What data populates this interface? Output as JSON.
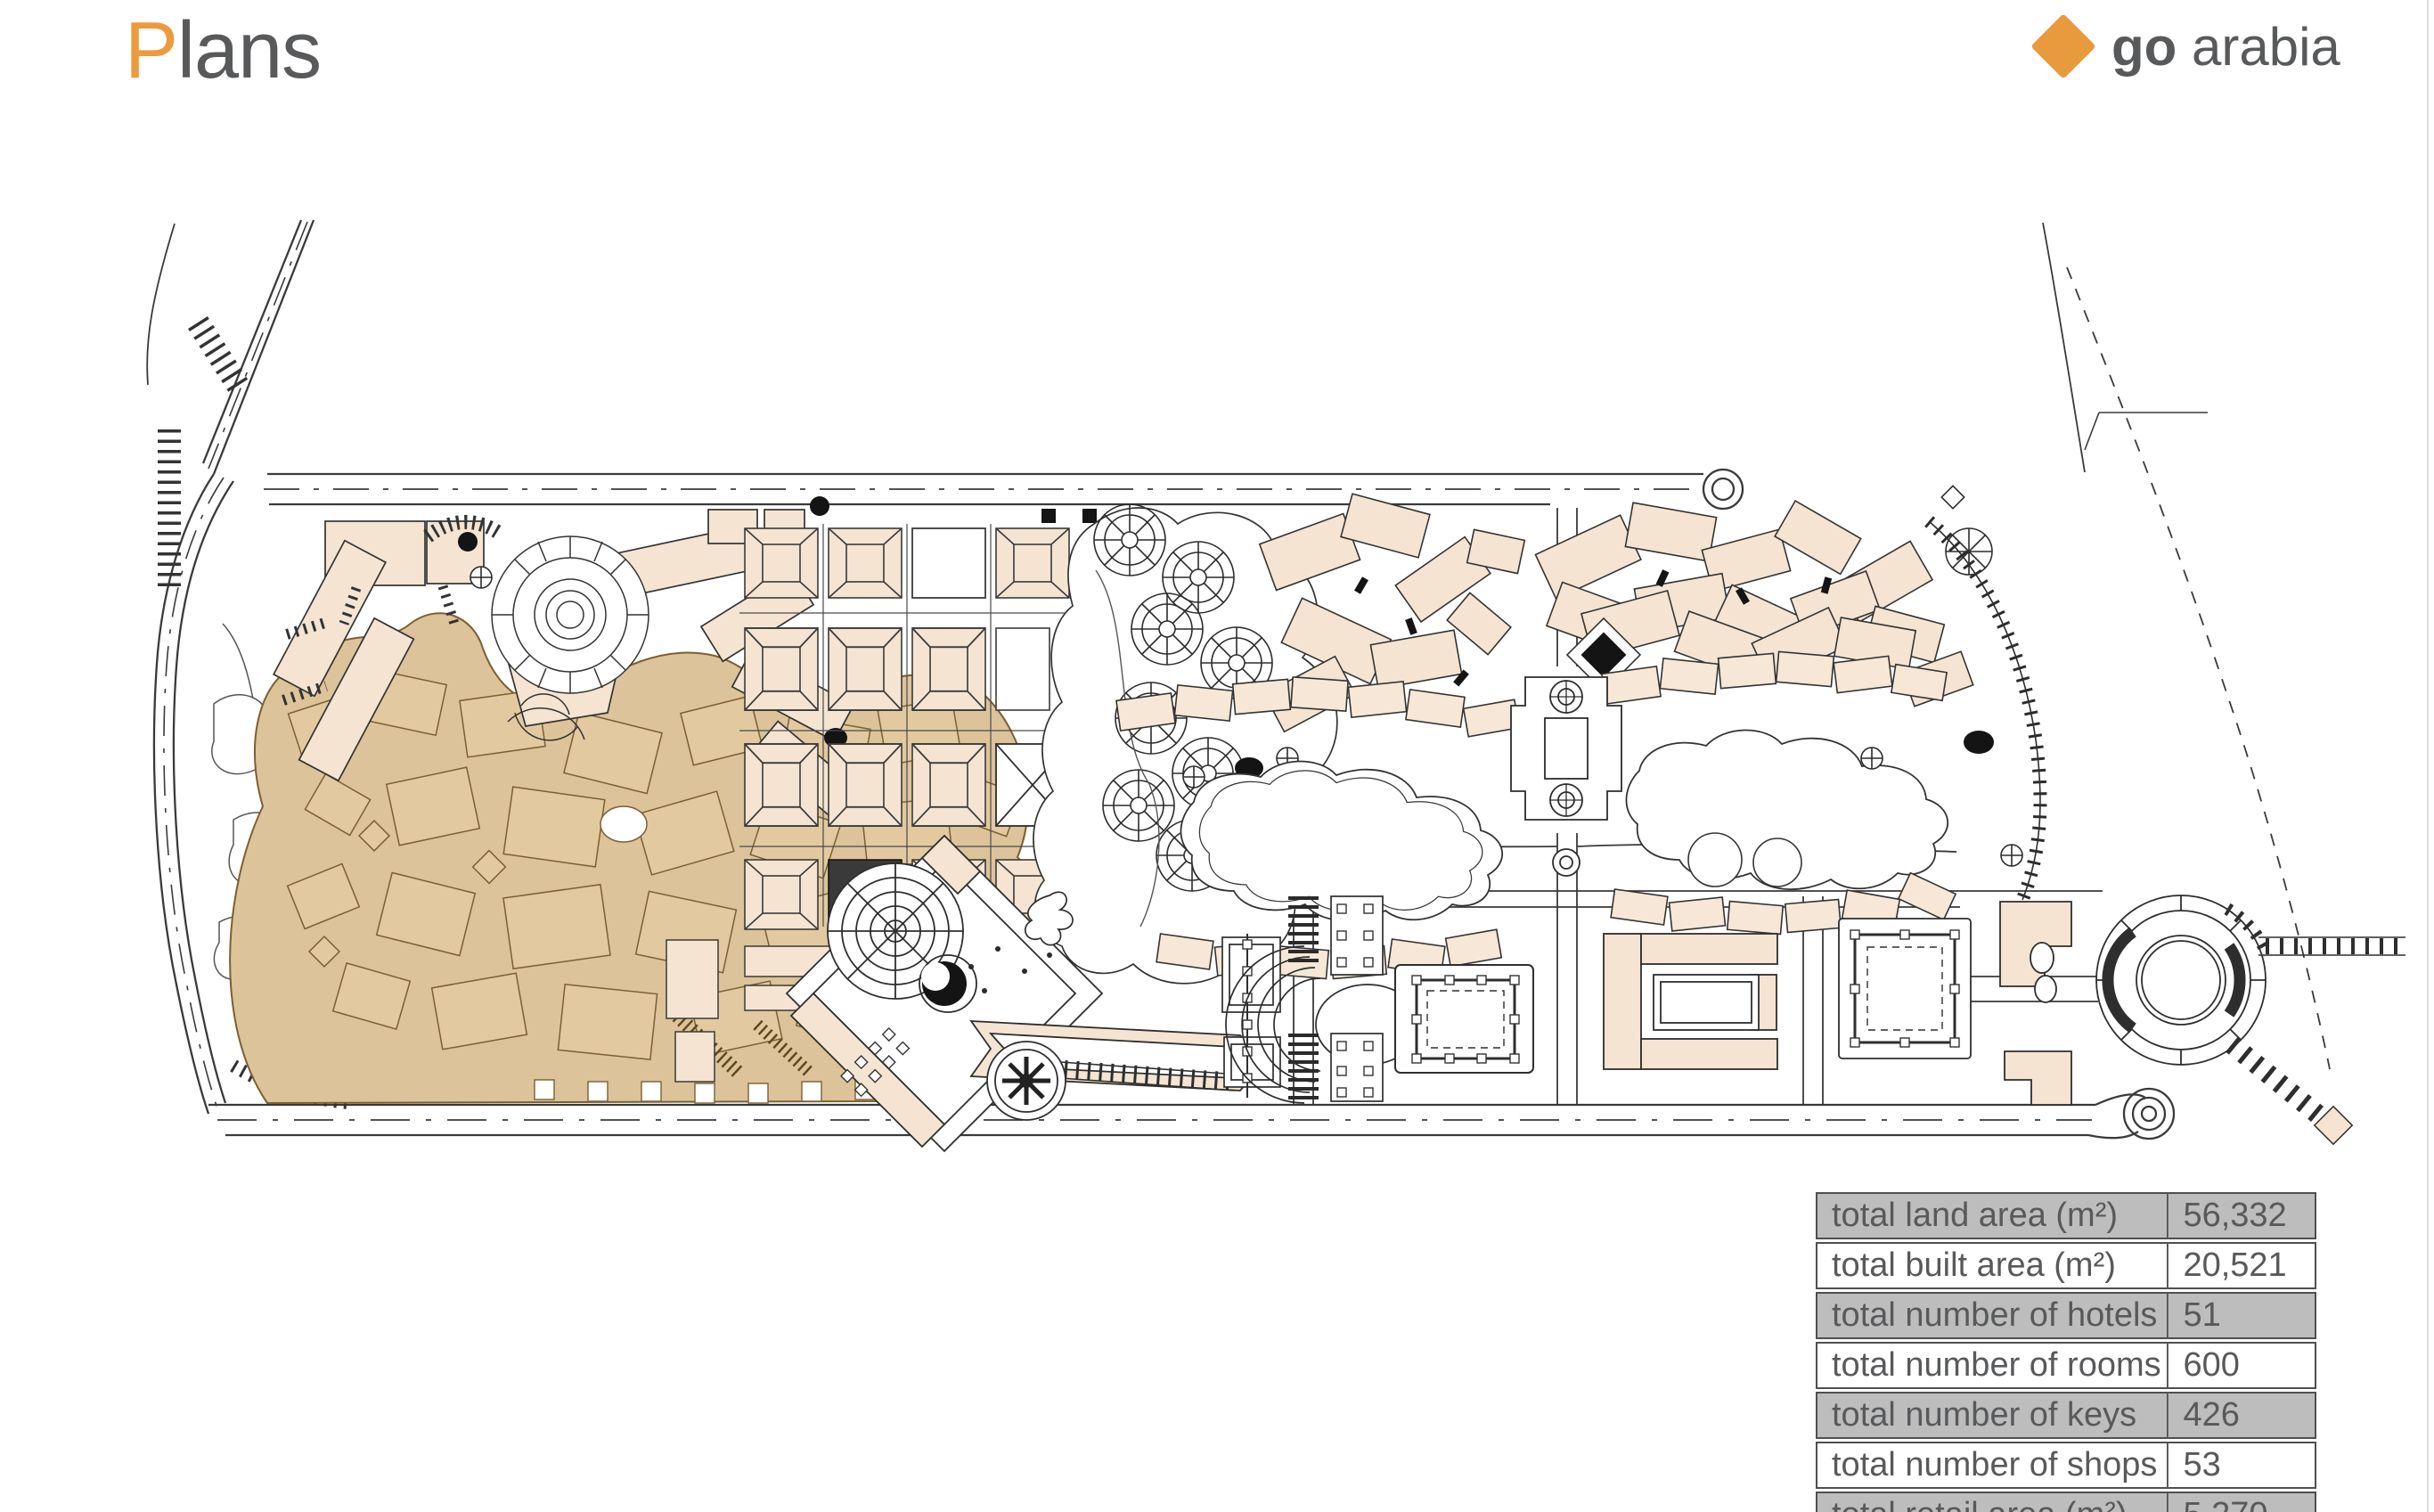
{
  "header": {
    "title_prefix": "P",
    "title_rest": "lans",
    "accent_color": "#EC9A3C",
    "text_color": "#58595B"
  },
  "logo": {
    "bold_text": "go",
    "regular_text": " arabia",
    "diamond_color": "#E89A3D",
    "text_color": "#58595B"
  },
  "map": {
    "type": "site-master-plan",
    "features": [
      "perimeter-roads",
      "old-town-souk-district",
      "hillside-resort-cluster",
      "souk-grid-blocks",
      "palm-garden",
      "village-cluster-west",
      "village-cluster-east",
      "lagoon-villas-west",
      "lagoon-villas-east",
      "central-plaza-diamond",
      "boardwalk-pier",
      "courtyard-hotel",
      "twin-courtyard-hotel",
      "round-hotel-marina",
      "beach-pier",
      "coastline",
      "parking-strips",
      "gardens"
    ],
    "palette": {
      "line": "#3A3A3A",
      "building_fill": "#F4E4D1",
      "district_fill": "#DCC39A",
      "district_building_fill": "#E2C9A0",
      "district_outline": "#7C5F31",
      "accent_black": "#141414"
    }
  },
  "stats": {
    "rows": [
      {
        "label": "total land area (m²)",
        "value": "56,332"
      },
      {
        "label": "total built area (m²)",
        "value": "20,521"
      },
      {
        "label": "total number of hotels",
        "value": "51"
      },
      {
        "label": "total number of rooms",
        "value": "600"
      },
      {
        "label": "total number of keys",
        "value": "426"
      },
      {
        "label": "total number of shops",
        "value": "53"
      },
      {
        "label": "total retail area (m²)",
        "value": "5,270"
      }
    ],
    "row_bg_odd": "#BDBDBD",
    "row_bg_even": "#FFFFFF",
    "text_color": "#58595B",
    "border_color": "#4F4F4F"
  }
}
